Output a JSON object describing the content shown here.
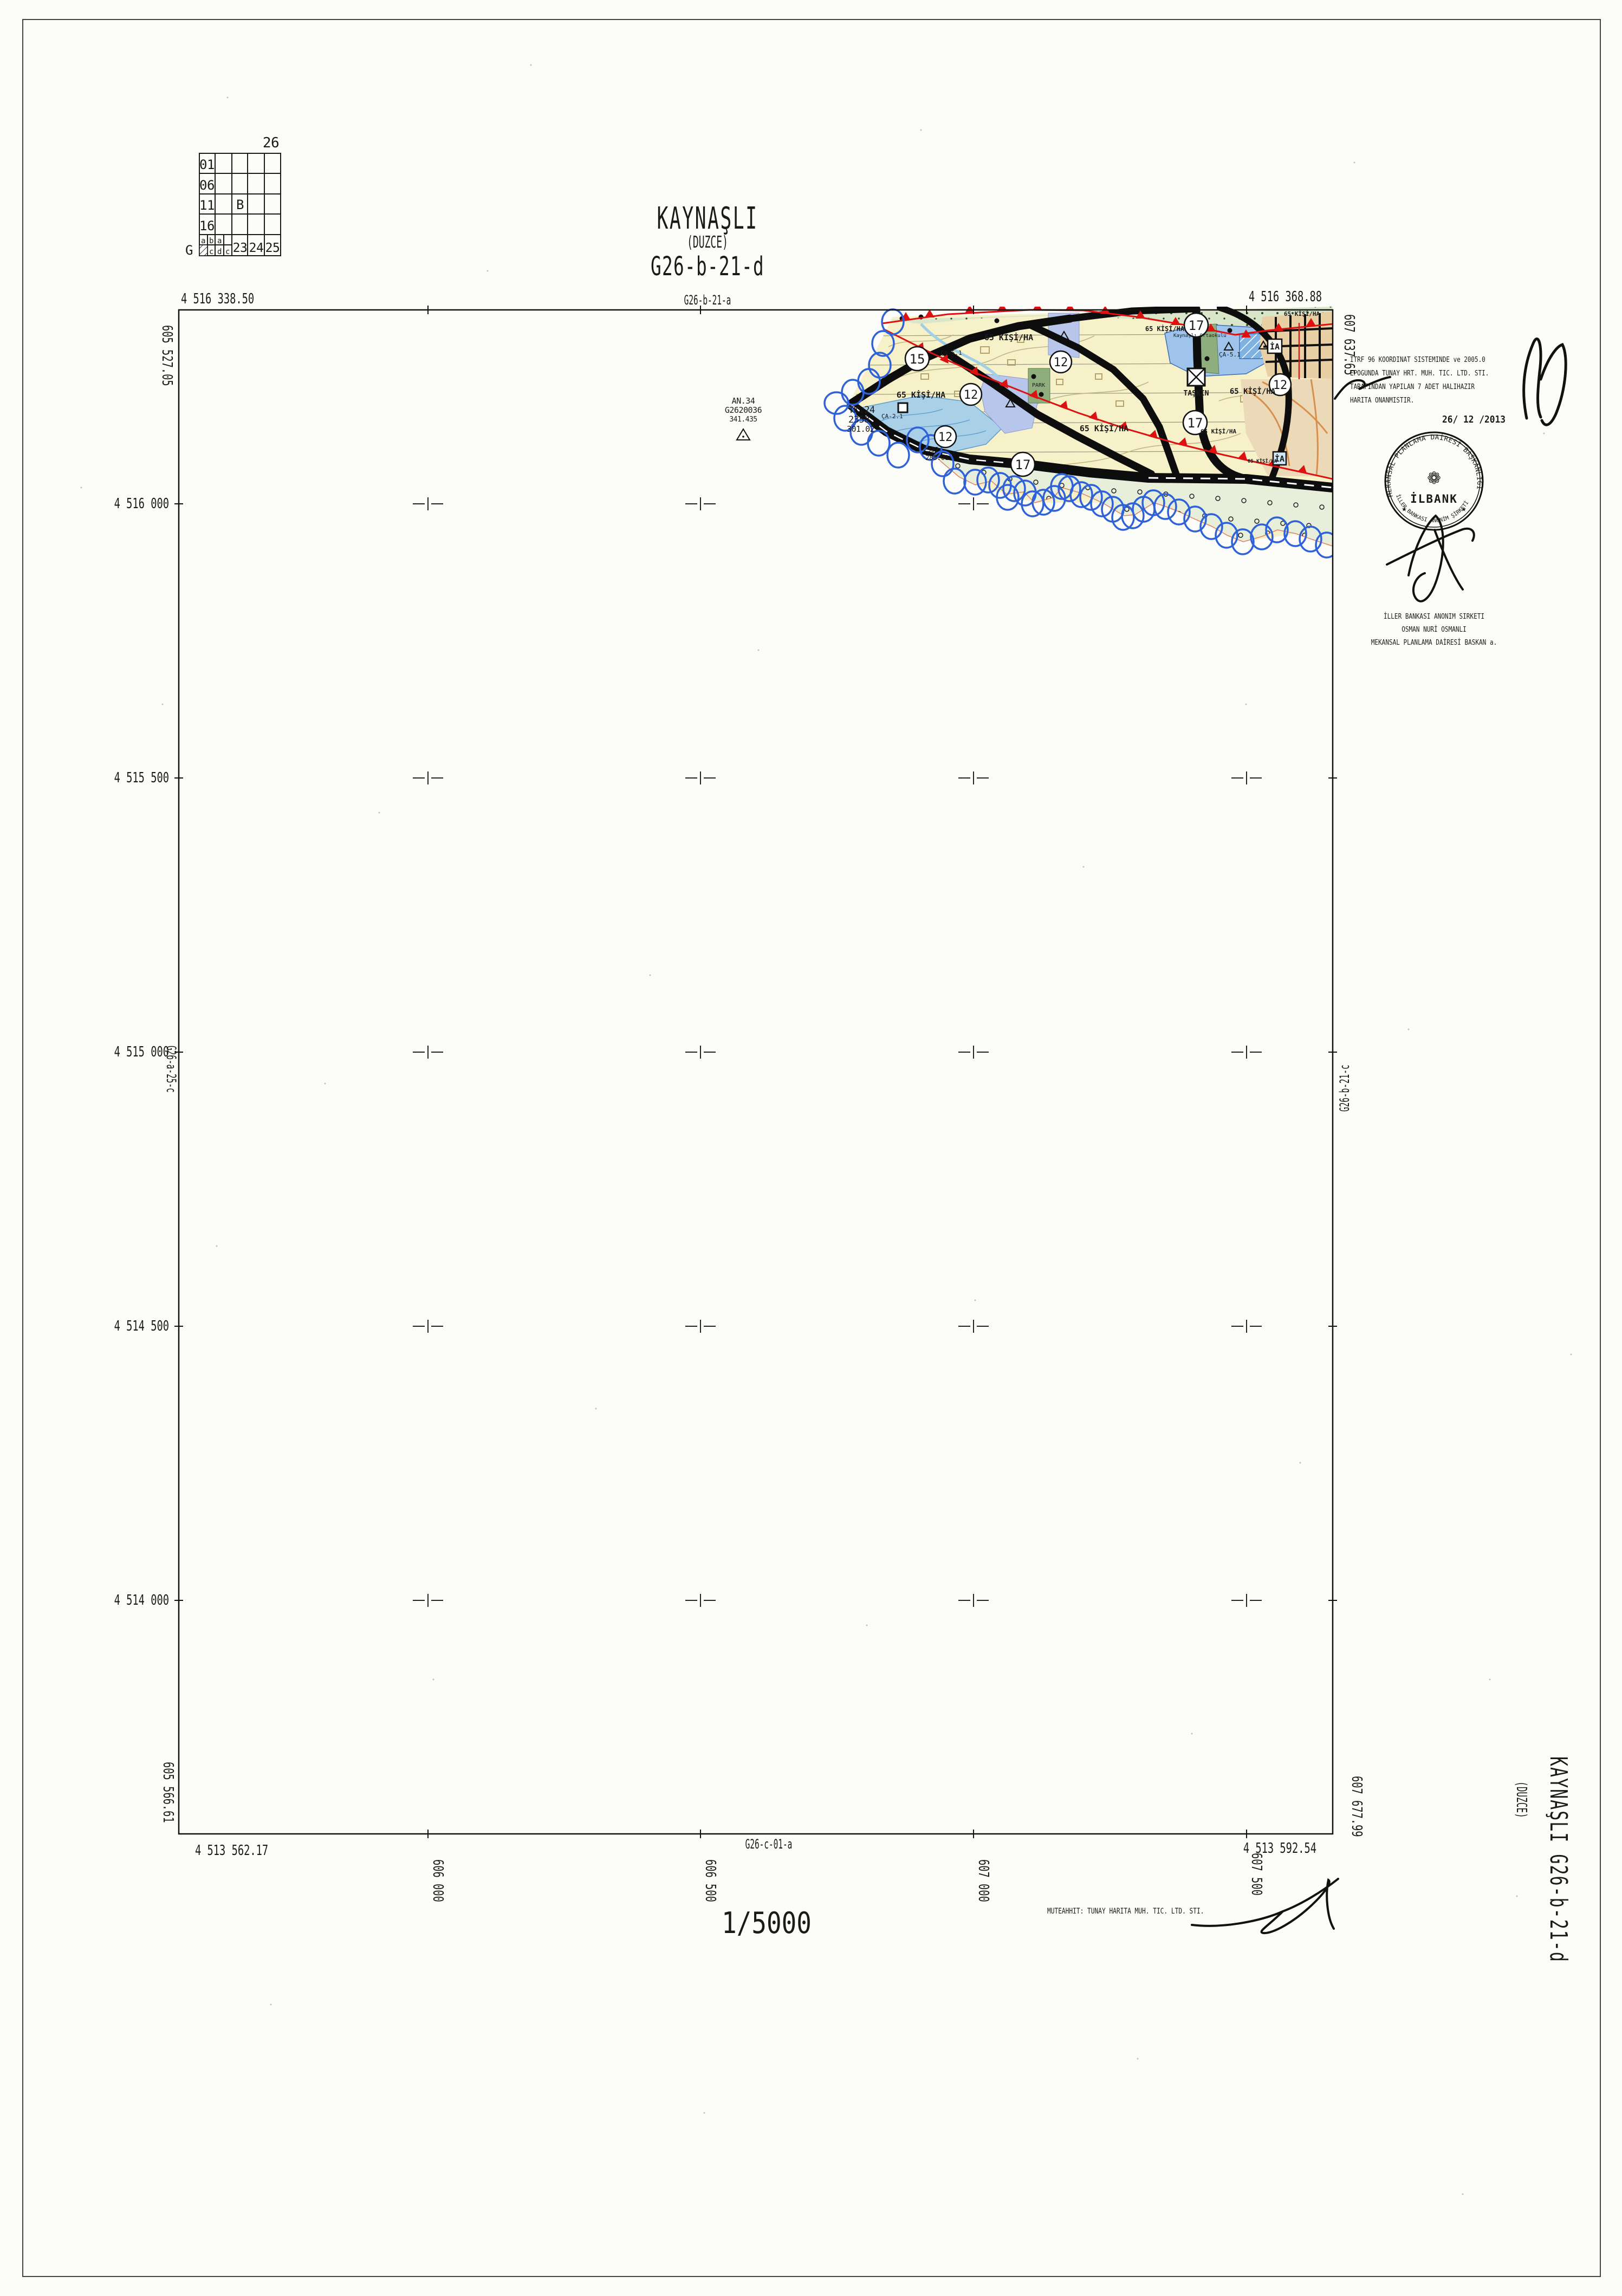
{
  "title_block": {
    "name": "KAYNAŞLI",
    "province": "(DUZCE)",
    "sheet": "G26-b-21-d"
  },
  "neighbors": {
    "top": "G26-b-21-a",
    "bottom": "G26-c-01-a",
    "left": "G26-a-25-c",
    "right": "G26-b-21-c"
  },
  "index_grid": {
    "zone_label": "26",
    "corner_label": "G",
    "row_labels": [
      "01",
      "06",
      "11",
      "16"
    ],
    "center_label": "B",
    "sub_top": [
      "a",
      "b",
      "a"
    ],
    "sub_bottom": [
      "c",
      "d",
      "c"
    ],
    "bottom_numbers": [
      "23",
      "24",
      "25"
    ]
  },
  "corners": {
    "tl_n": "4 516 338.50",
    "tl_e": "605 527.05",
    "tr_n": "4 516 368.88",
    "tr_e": "607 637.65",
    "bl_n": "4 513 562.17",
    "bl_e": "605 566.61",
    "br_n": "4 513 592.54",
    "br_e": "607 677.99"
  },
  "grid": {
    "northings": [
      "4 516 000",
      "4 515 500",
      "4 515 000",
      "4 514 500",
      "4 514 000"
    ],
    "eastings": [
      "606 000",
      "606 500",
      "607 000",
      "607 500"
    ]
  },
  "map": {
    "density": "65 KİŞİ/HA",
    "park": "PARK",
    "ia": "İA",
    "taskin": "TAŞKIN",
    "school": "Kaynaşlı Ortaokulu",
    "roads": {
      "r15": "15",
      "r12": "12",
      "r17": "17"
    },
    "zones": {
      "ca51": "ÇA-5.1",
      "ca21": "ÇA-2.1"
    },
    "pt_an": [
      "AN.34",
      "G2620036",
      "341.435"
    ],
    "pt_tk": [
      "TK.24",
      "2358",
      "301.02"
    ],
    "pt_blue": [
      "2352",
      "288.01"
    ]
  },
  "scale": "1/5000",
  "notes": {
    "approval": [
      "ITRF 96 KOORDINAT SISTEMINDE ve 2005.0",
      "EPOGUNDA TUNAY HRT. MUH. TIC. LTD. STI.",
      "TARAFINDAN YAPILAN 7 ADET HALIHAZIR",
      "HARITA ONANMISTIR."
    ],
    "date": "26/ 12 /2013",
    "contractor": "MUTEAHHIT: TUNAY HARITA MUH. TIC. LTD. STI.",
    "officer": [
      "İLLER BANKASI ANONIM SIRKETI",
      "OSMAN NURİ OSMANLI",
      "MEKANSAL PLANLAMA DAİRESİ BASKAN a."
    ]
  },
  "stamp": {
    "ring_top": "MEKANSAL PLANLAMA DAİRESİ BAŞKANLIĞI",
    "ring_bottom": "İLLER BANKASI ANONİM ŞİRKETİ",
    "center": "İLBANK",
    "star": "★",
    "flower": "❁"
  },
  "side_title": {
    "main": "KAYNAŞLI  G26-b-21-d",
    "sub": "(DUZCE)"
  }
}
